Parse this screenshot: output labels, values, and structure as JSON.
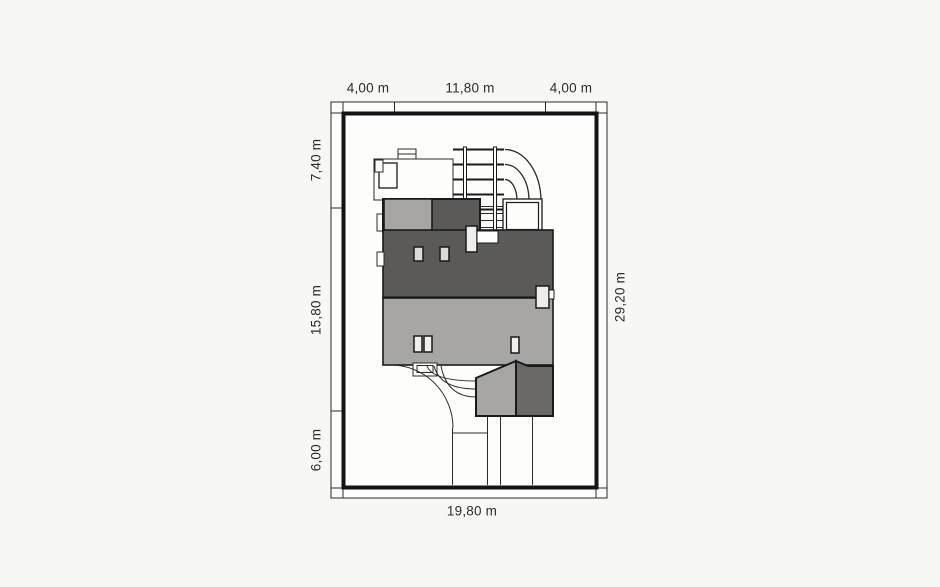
{
  "plan": {
    "type": "house-site-plan",
    "dimensions": {
      "top": [
        "4,00 m",
        "11,80 m",
        "4,00 m"
      ],
      "left": [
        "7,40 m",
        "15,80 m",
        "6,00 m"
      ],
      "right": "29,20 m",
      "bottom": "19,80 m"
    },
    "colors": {
      "page_background": "#f7f7f5",
      "plot_background": "#fdfdfc",
      "outline": "#1a1a1a",
      "roof_dark": "#5c5a58",
      "roof_light": "#a8a6a4",
      "garage_roof_dark": "#6b6967",
      "chimney_light": "#efedeb"
    }
  }
}
